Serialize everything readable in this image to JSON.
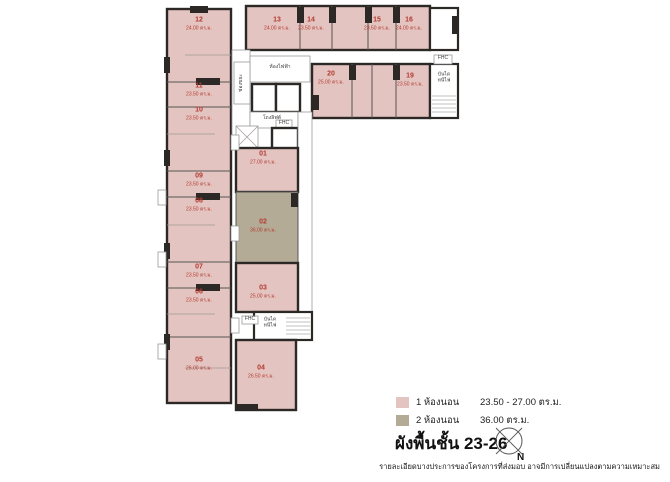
{
  "page": {
    "title": "ผังพื้นชั้น 23-26",
    "compass_label": "N",
    "disclaimer": "รายละเอียดบางประการของโครงการที่ส่งมอบ อาจมีการเปลี่ยนแปลงตามความเหมาะสม"
  },
  "legend": {
    "items": [
      {
        "label": "1 ห้องนอน",
        "value": "23.50 - 27.00 ตร.ม.",
        "color": "#e4c4c0"
      },
      {
        "label": "2 ห้องนอน",
        "value": "36.00 ตร.ม.",
        "color": "#b3ab96"
      }
    ]
  },
  "plan": {
    "colors": {
      "one_bed": "#e4c4c0",
      "two_bed": "#b3ab96",
      "wall": "#2b2826",
      "unit_text": "#b33a31"
    },
    "labels": {
      "electrical_room": "ห้องไฟฟ้า",
      "lift_lobby": "โถงลิฟต์",
      "garbage_chute": "ช่องขยะ",
      "fhc": "FHC",
      "fire_stair": "บันได\nหนีไฟ"
    },
    "units": [
      {
        "no": "01",
        "area": "27.00 ตร.ม.",
        "type": "1bed",
        "cx": 263,
        "cy": 158
      },
      {
        "no": "02",
        "area": "36.00 ตร.ม.",
        "type": "2bed",
        "cx": 263,
        "cy": 226
      },
      {
        "no": "03",
        "area": "25.00 ตร.ม.",
        "type": "1bed",
        "cx": 263,
        "cy": 292
      },
      {
        "no": "04",
        "area": "26.50 ตร.ม.",
        "type": "1bed",
        "cx": 261,
        "cy": 372
      },
      {
        "no": "05",
        "area": "26.00 ตร.ม.",
        "type": "1bed",
        "cx": 199,
        "cy": 364
      },
      {
        "no": "06",
        "area": "23.50 ตร.ม.",
        "type": "1bed",
        "cx": 199,
        "cy": 296
      },
      {
        "no": "07",
        "area": "23.50 ตร.ม.",
        "type": "1bed",
        "cx": 199,
        "cy": 271
      },
      {
        "no": "08",
        "area": "23.50 ตร.ม.",
        "type": "1bed",
        "cx": 199,
        "cy": 205
      },
      {
        "no": "09",
        "area": "23.50 ตร.ม.",
        "type": "1bed",
        "cx": 199,
        "cy": 180
      },
      {
        "no": "10",
        "area": "23.50 ตร.ม.",
        "type": "1bed",
        "cx": 199,
        "cy": 114
      },
      {
        "no": "11",
        "area": "23.50 ตร.ม.",
        "type": "1bed",
        "cx": 199,
        "cy": 90
      },
      {
        "no": "12",
        "area": "24.00 ตร.ม.",
        "type": "1bed",
        "cx": 199,
        "cy": 24
      },
      {
        "no": "13",
        "area": "24.00 ตร.ม.",
        "type": "1bed",
        "cx": 277,
        "cy": 24
      },
      {
        "no": "14",
        "area": "23.50 ตร.ม.",
        "type": "1bed",
        "cx": 311,
        "cy": 24
      },
      {
        "no": "15",
        "area": "23.50 ตร.ม.",
        "type": "1bed",
        "cx": 377,
        "cy": 24
      },
      {
        "no": "16",
        "area": "24.00 ตร.ม.",
        "type": "1bed",
        "cx": 409,
        "cy": 24
      },
      {
        "no": "19",
        "area": "23.50 ตร.ม.",
        "type": "1bed",
        "cx": 410,
        "cy": 80
      },
      {
        "no": "20",
        "area": "25.00 ตร.ม.",
        "type": "1bed",
        "cx": 331,
        "cy": 78
      }
    ]
  }
}
